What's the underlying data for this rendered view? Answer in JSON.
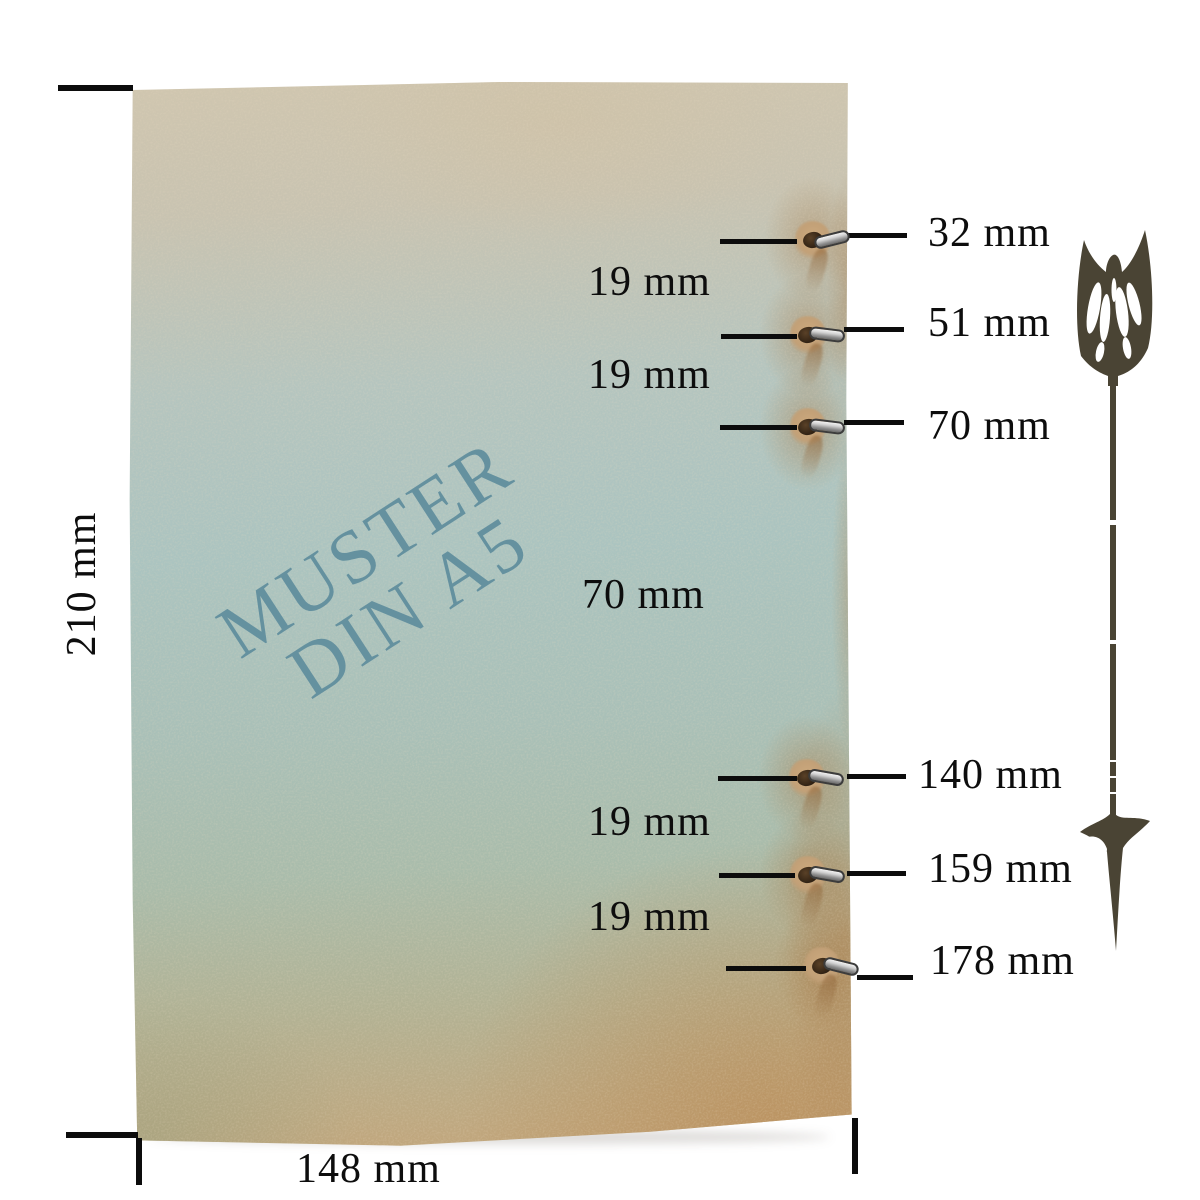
{
  "image_type": "notebook hole-position measurement diagram",
  "watermark": {
    "line1": "MUSTER",
    "line2": "DIN A5"
  },
  "dimensions": {
    "height_label": "210 mm",
    "width_label": "148 mm"
  },
  "holes": {
    "position_labels": [
      "32 mm",
      "51 mm",
      "70 mm",
      "140 mm",
      "159 mm",
      "178 mm"
    ],
    "gap_labels": [
      "19 mm",
      "19 mm",
      "70 mm",
      "19 mm",
      "19 mm"
    ]
  },
  "icons": {
    "arrow": "rustic-down-arrow",
    "ring": "metal-binder-ring"
  },
  "colors": {
    "annotation_text": "#0d0d0d",
    "watermark_teal": "#5f8d9d",
    "arrow_olive": "#4a4434",
    "paper_beige_top": "#d0c6af",
    "paper_blue_middle": "#abc4c0",
    "paper_tan_bottom": "#c0a77e",
    "ring_silver": "#d0d0d0",
    "hole_brown": "#2d1f12"
  }
}
